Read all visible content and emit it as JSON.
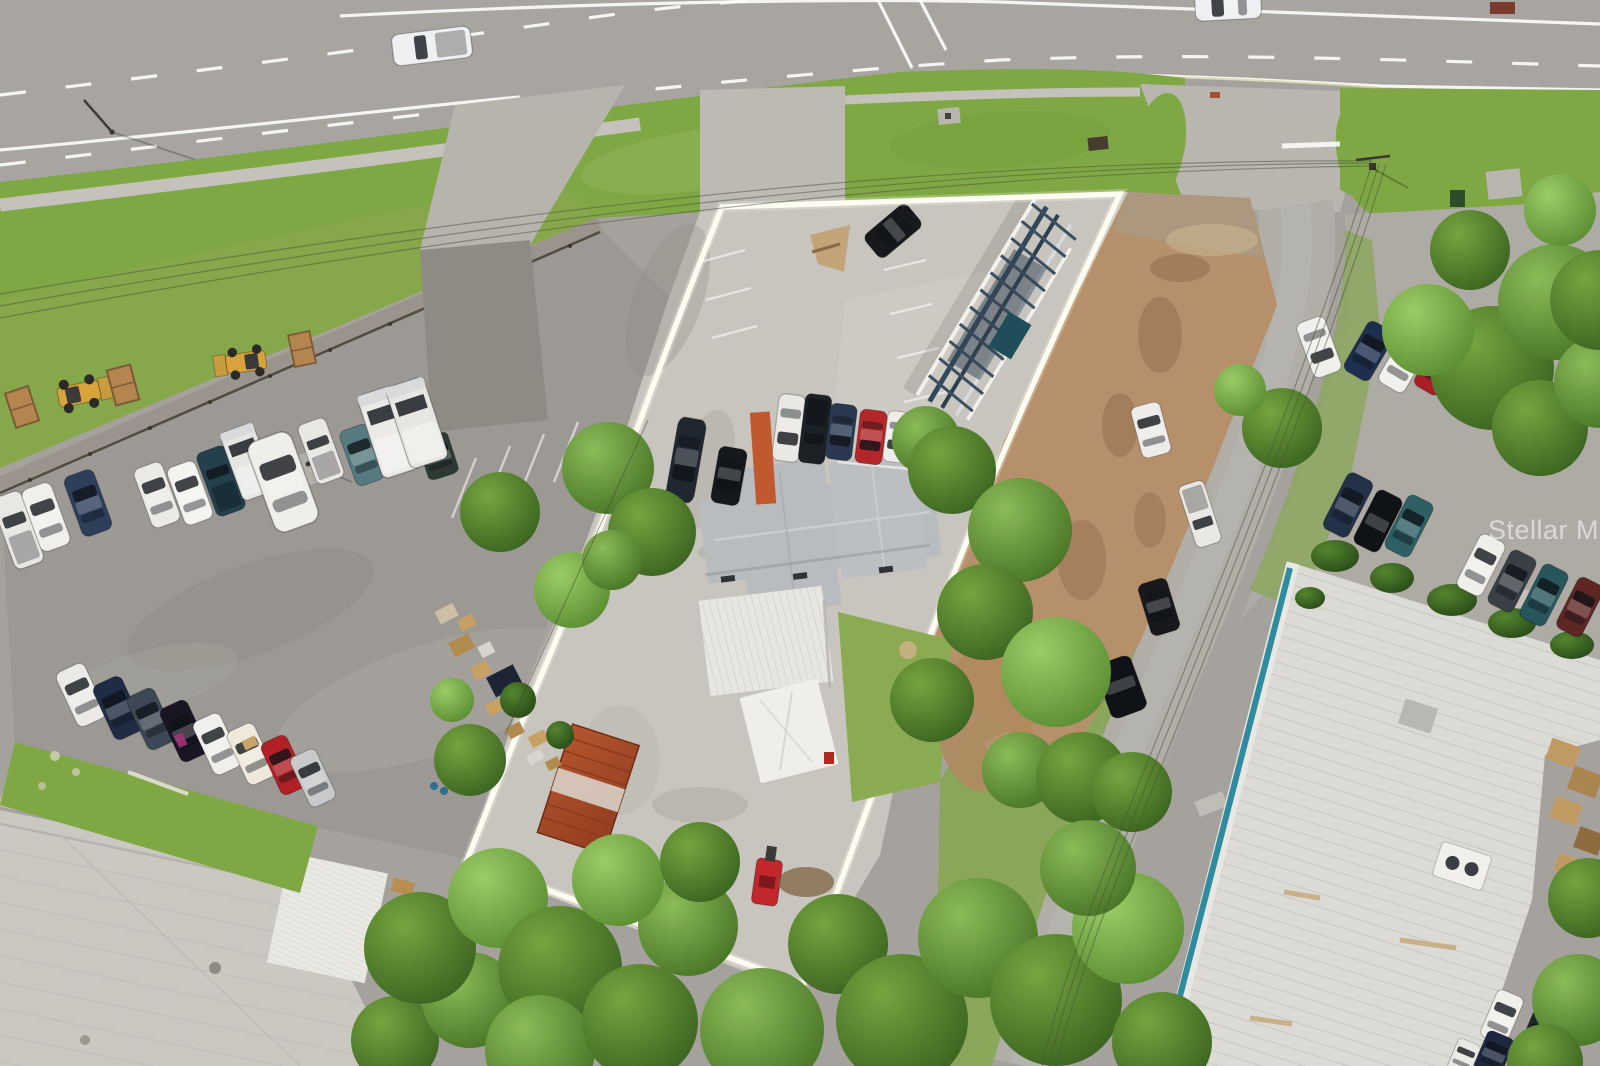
{
  "watermark": {
    "text": "Stellar MLS"
  },
  "scene": {
    "type": "aerial-drone-photo",
    "subject": "commercial parcel outlined with white property boundary beside a multi-lane highway"
  },
  "palette": {
    "road": "#a8a5a0",
    "asphalt_lot": "#9c9994",
    "concrete": "#c8c5be",
    "grass": "#7fa844",
    "dirt": "#b5906a",
    "tree_dark": "#3f6b24",
    "roof_shingle": "#b9bcbf",
    "roof_metal_white": "#e7e6e1",
    "roof_warehouse_sw": "#cbc8c2",
    "roof_industrial_se": "#dbdad5",
    "roof_edge_teal": "#2f8ba0",
    "container_rust": "#b0522d",
    "billboard_steel": "#33495a",
    "property_line": "#fdfcf0"
  },
  "vehicle_counts": {
    "on_highway": 2,
    "left_lot_row": 13,
    "inside_property": 9,
    "street_parked": 7,
    "right_parking": 11,
    "grass_row_southwest": 8,
    "corner_southeast": 4,
    "construction_equipment": 5
  }
}
